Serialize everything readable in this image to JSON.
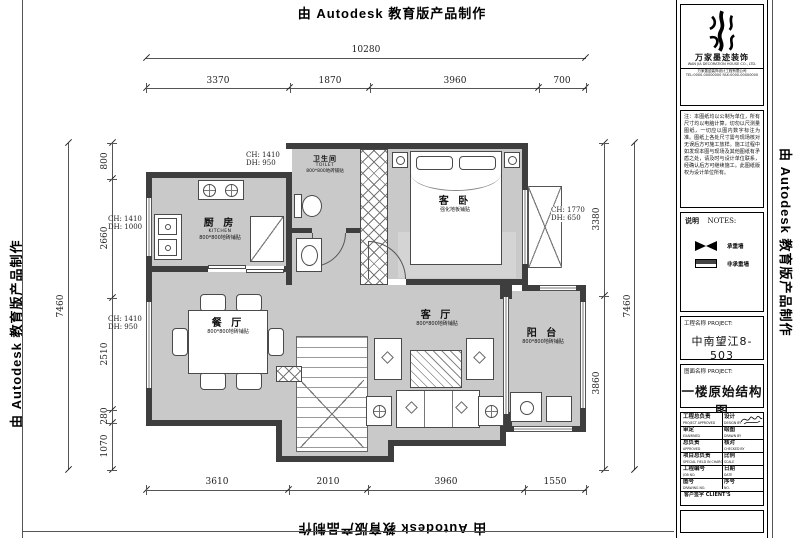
{
  "branding": {
    "text": "由 Autodesk 教育版产品制作"
  },
  "dims": {
    "top_total": "10280",
    "top_segments": [
      "3370",
      "1870",
      "3960",
      "700"
    ],
    "bottom_segments": [
      "3610",
      "2010",
      "3960",
      "1550"
    ],
    "left_total": "7460",
    "left_segments": [
      "800",
      "2660",
      "2510",
      "280",
      "1070"
    ],
    "right_total": "7460",
    "right_segments": [
      "3380",
      "3860"
    ]
  },
  "window_labels": [
    {
      "ch": "CH: 1410",
      "dh": "DH: 950"
    },
    {
      "ch": "CH: 1410",
      "dh": "DH: 1000"
    },
    {
      "ch": "CH: 1410",
      "dh": "DH: 950"
    },
    {
      "ch": "CH: 1770",
      "dh": "DH: 650"
    }
  ],
  "rooms": {
    "kitchen": {
      "name": "厨 房",
      "eng": "KITCHEN",
      "finish": "800*800地砖铺贴"
    },
    "bath": {
      "name": "卫生间",
      "eng": "TOILET",
      "finish": "800*800地砖铺贴"
    },
    "bedroom": {
      "name": "客 卧",
      "finish": "强化地板铺贴"
    },
    "dining": {
      "name": "餐 厅",
      "finish": "800*800地砖铺贴"
    },
    "living": {
      "name": "客 厅",
      "finish": "800*800地砖铺贴"
    },
    "balcony": {
      "name": "阳 台",
      "finish": "800*800地砖铺贴"
    }
  },
  "titleblock": {
    "company_cn": "万家墨迹装饰",
    "company_en": "WAN JIA DECORATION HOUSE CO., LTD.",
    "addr1": "万家墨迹装饰设计工程有限公司",
    "addr2": "TEL:0000-00000000  FAX:0000-00000000",
    "notes_body": "注：本图纸均以公制为单位，所有尺寸均以电脑计算，切勿以尺测量图纸，一切应以图内数字标注为准。图纸上各处尺寸需与现场核对无误后方可施工放样。施工过程中如发现本图与现场及其他图纸有矛盾之处，请及时与设计单位联系，经确认后方可继续施工。此图纸版权为设计单位所有。",
    "note_cn": "说明",
    "note_en": "NOTES:",
    "legend": [
      {
        "label": "承重墙"
      },
      {
        "label": "非承重墙"
      }
    ],
    "project_label": "工程名称 PROJECT:",
    "project_value": "中南望江8-503",
    "drawing_label": "图面名称 PROJECT:",
    "drawing_value": "一楼原始结构图",
    "table": [
      [
        "工程总负责",
        "PROJECT APPROVED",
        "设计",
        "DESIGN BY"
      ],
      [
        "审定",
        "EXAMINED",
        "绘图",
        "DRAWN BY"
      ],
      [
        "总负责",
        "APPROVED",
        "核对",
        "CHECKED BY"
      ],
      [
        "项目总负责",
        "SPECIAL FIELD IN CHARGE",
        "比例",
        "SCALE"
      ],
      [
        "工程编号",
        "JOB NO.",
        "日期",
        "DATE"
      ],
      [
        "图号",
        "DRAWING NO.",
        "序号",
        "NO."
      ]
    ],
    "client_label": "客户签字 CLIENT'S"
  }
}
